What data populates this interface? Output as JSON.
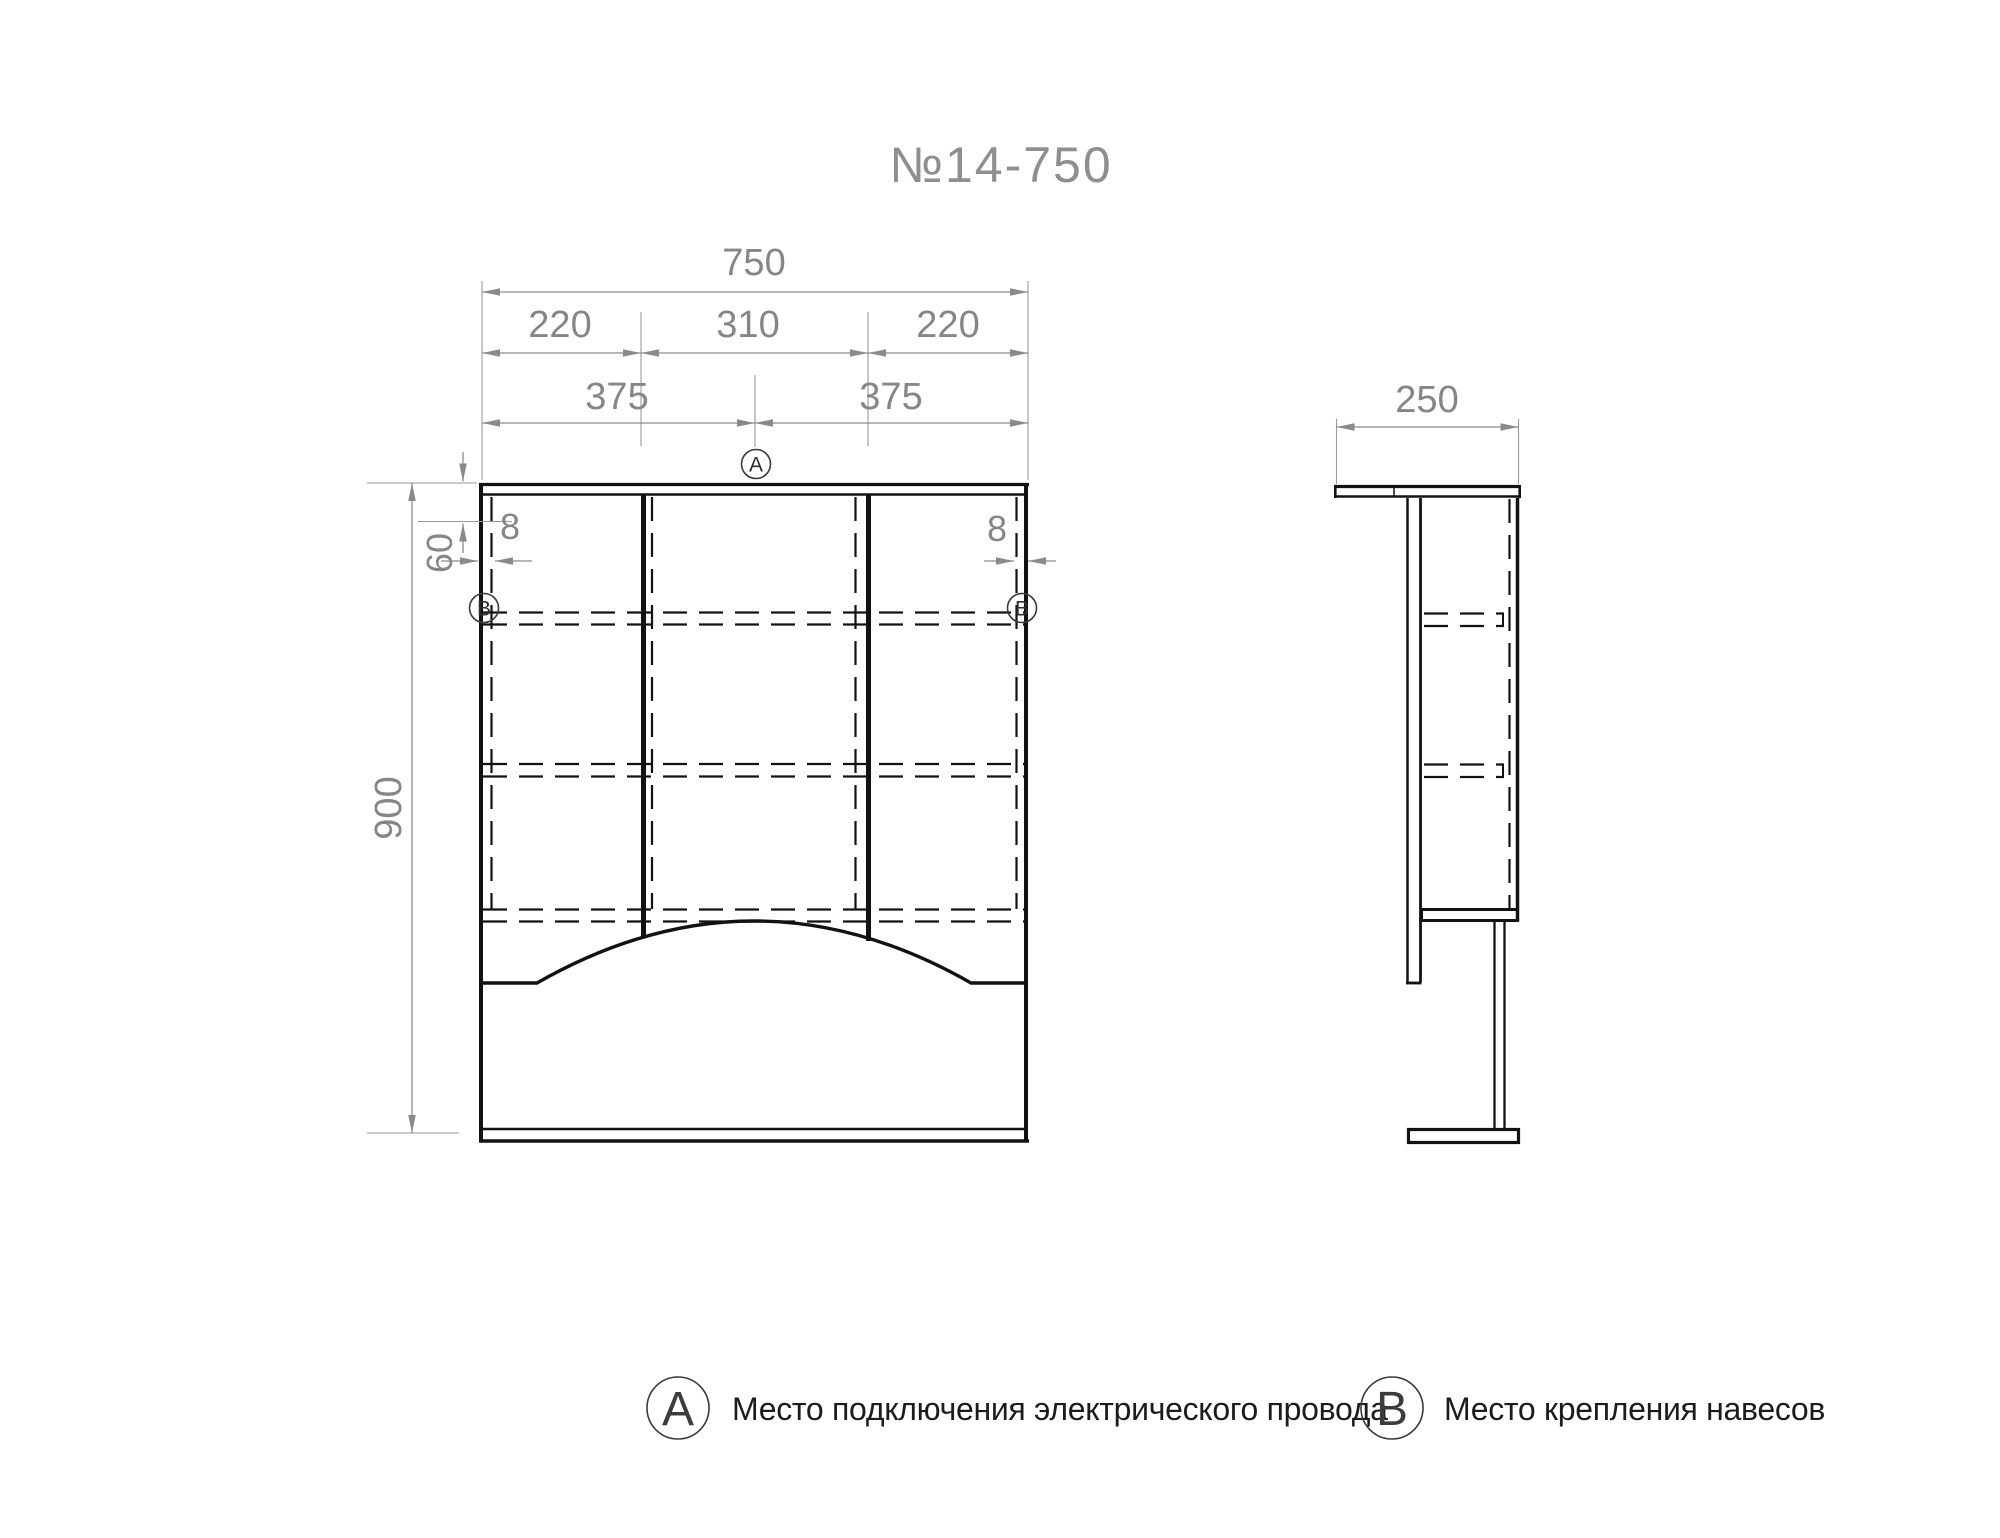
{
  "title": "№14-750",
  "front_view": {
    "dim_total_width": "750",
    "dim_left_section": "220",
    "dim_center_section": "310",
    "dim_right_section": "220",
    "dim_half_left": "375",
    "dim_half_right": "375",
    "dim_height": "900",
    "dim_hanger_offset": "60",
    "dim_left_inset": "8",
    "dim_right_inset": "8",
    "marker_a": "A",
    "marker_b_left": "B",
    "marker_b_right": "B"
  },
  "side_view": {
    "dim_depth": "250"
  },
  "legend": {
    "marker_a": "A",
    "label_a": "Место подключения электрического провода",
    "marker_b": "B",
    "label_b": "Место крепления навесов"
  },
  "colors": {
    "drawing_line": "#121212",
    "dimension_line": "#8a8a8a",
    "dimension_text": "#868686",
    "title_text": "#8f8f8f",
    "legend_text": "#1c1c1c",
    "background": "#ffffff"
  }
}
